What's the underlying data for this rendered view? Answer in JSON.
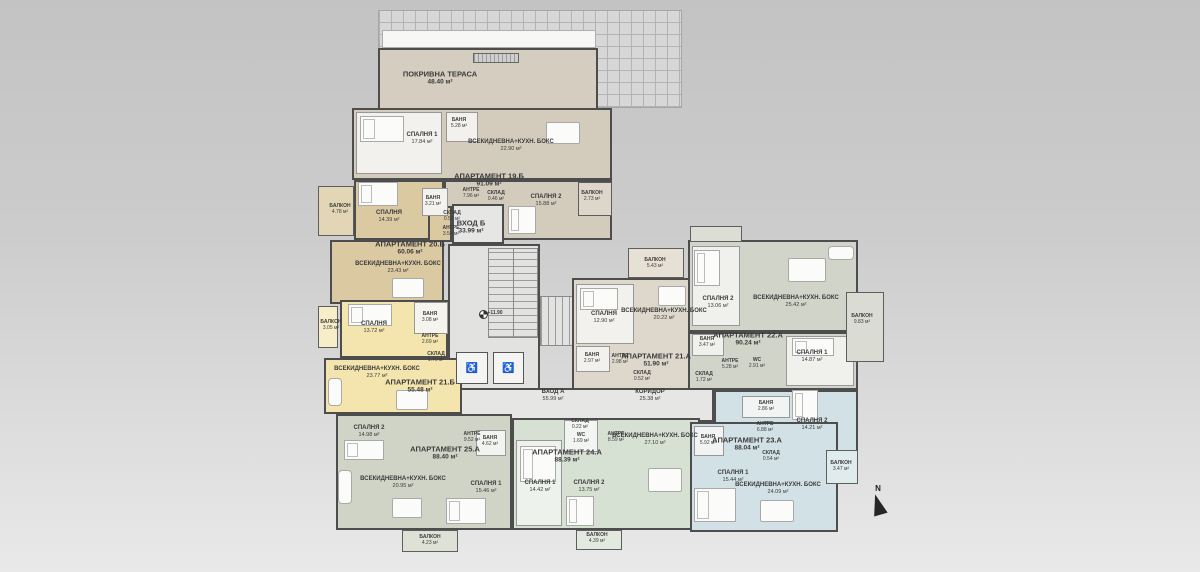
{
  "plan_title": "Floor plan level +11.90",
  "north": {
    "label": "N"
  },
  "level": {
    "label": "+11.90"
  },
  "colors": {
    "wall": "#4d4d4d",
    "apt19": "#d3cbbc",
    "apt20": "#dbc9a2",
    "apt21b": "#f4e5ae",
    "apt21a": "#ddd8cb",
    "apt22": "#d0d4c9",
    "apt23": "#d2e1e5",
    "apt24": "#d6e1d3",
    "apt25": "#cfd4c7",
    "terrace": "#d5cdbf",
    "common": "#e4e4e2"
  },
  "regions": [
    {
      "id": "roof-hatch",
      "cls": "roof",
      "x": 378,
      "y": 10,
      "w": 304,
      "h": 98,
      "fill": "#d7d7d7"
    },
    {
      "id": "terrace-strip",
      "cls": "strip",
      "x": 382,
      "y": 30,
      "w": 214,
      "h": 18,
      "fill": "#f7f7f5"
    },
    {
      "id": "roof-terrace",
      "cls": "apartment",
      "x": 378,
      "y": 48,
      "w": 220,
      "h": 64,
      "fill": "#d5cdbf"
    },
    {
      "id": "terrace-vent",
      "cls": "vent",
      "x": 473,
      "y": 53,
      "w": 46,
      "h": 10,
      "fill": "#cfcfcf"
    },
    {
      "id": "corridor",
      "cls": "core",
      "x": 452,
      "y": 388,
      "w": 262,
      "h": 34,
      "fill": "#e6e6e4"
    },
    {
      "id": "core-stairwell",
      "cls": "core",
      "x": 448,
      "y": 244,
      "w": 92,
      "h": 146,
      "fill": "#e2e2e0"
    },
    {
      "id": "apt19-main",
      "cls": "apartment",
      "x": 352,
      "y": 108,
      "w": 260,
      "h": 72,
      "fill": "#d3cbbc"
    },
    {
      "id": "apt19-south",
      "cls": "apartment",
      "x": 444,
      "y": 180,
      "w": 168,
      "h": 60,
      "fill": "#d3cbbc"
    },
    {
      "id": "entrance-b-hall",
      "cls": "core",
      "x": 452,
      "y": 204,
      "w": 52,
      "h": 40,
      "fill": "#e6e6e4"
    },
    {
      "id": "apt19-bedroom1-room",
      "cls": "room",
      "x": 356,
      "y": 112,
      "w": 86,
      "h": 62,
      "fill": "#f2f1ed"
    },
    {
      "id": "apt19-bath-room",
      "cls": "room",
      "x": 446,
      "y": 112,
      "w": 32,
      "h": 30,
      "fill": "#f2f1ed"
    },
    {
      "id": "apt19-balcony",
      "cls": "balcony",
      "x": 578,
      "y": 182,
      "w": 34,
      "h": 34,
      "fill": "#ddd6c9"
    },
    {
      "id": "apt20-bedroom-wing",
      "cls": "apartment",
      "x": 354,
      "y": 180,
      "w": 90,
      "h": 60,
      "fill": "#dbc9a2"
    },
    {
      "id": "apt20-living",
      "cls": "apartment",
      "x": 330,
      "y": 240,
      "w": 114,
      "h": 64,
      "fill": "#dbc9a2"
    },
    {
      "id": "apt20-hall",
      "cls": "apartment",
      "x": 428,
      "y": 206,
      "w": 24,
      "h": 36,
      "fill": "#dbc9a2"
    },
    {
      "id": "apt20-bath-room",
      "cls": "room",
      "x": 422,
      "y": 188,
      "w": 26,
      "h": 28,
      "fill": "#f4f2ee"
    },
    {
      "id": "apt20-balcony",
      "cls": "balcony",
      "x": 318,
      "y": 186,
      "w": 36,
      "h": 50,
      "fill": "#e3d6b6"
    },
    {
      "id": "apt21b-bedroom-wing",
      "cls": "apartment",
      "x": 340,
      "y": 300,
      "w": 108,
      "h": 58,
      "fill": "#f4e5ae"
    },
    {
      "id": "apt21b-living",
      "cls": "apartment",
      "x": 324,
      "y": 358,
      "w": 138,
      "h": 56,
      "fill": "#f4e5ae"
    },
    {
      "id": "apt21b-bath-room",
      "cls": "room",
      "x": 414,
      "y": 302,
      "w": 34,
      "h": 32,
      "fill": "#f6f4ee"
    },
    {
      "id": "apt21b-balcony",
      "cls": "balcony",
      "x": 318,
      "y": 306,
      "w": 20,
      "h": 42,
      "fill": "#f7edc8"
    },
    {
      "id": "stairs-upper",
      "cls": "stairs",
      "x": 488,
      "y": 248,
      "w": 50,
      "h": 90,
      "fill": "#e2e2e0"
    },
    {
      "id": "stairs-lower",
      "cls": "stairs-h",
      "x": 540,
      "y": 296,
      "w": 44,
      "h": 50,
      "fill": "#e2e2e0"
    },
    {
      "id": "elevator-1",
      "cls": "elevator",
      "x": 456,
      "y": 352,
      "w": 32,
      "h": 32,
      "fill": "#f4f4f2",
      "icon": "♿"
    },
    {
      "id": "elevator-2",
      "cls": "elevator",
      "x": 493,
      "y": 352,
      "w": 31,
      "h": 32,
      "fill": "#f4f4f2",
      "icon": "♿"
    },
    {
      "id": "apt21a-main",
      "cls": "apartment",
      "x": 572,
      "y": 278,
      "w": 128,
      "h": 112,
      "fill": "#ddd8cb"
    },
    {
      "id": "apt21a-bedroom-room",
      "cls": "room",
      "x": 576,
      "y": 284,
      "w": 58,
      "h": 60,
      "fill": "#f2f1ed"
    },
    {
      "id": "apt21a-bath-room",
      "cls": "room",
      "x": 576,
      "y": 346,
      "w": 34,
      "h": 26,
      "fill": "#f2f1ed"
    },
    {
      "id": "apt21a-balcony",
      "cls": "balcony",
      "x": 628,
      "y": 248,
      "w": 56,
      "h": 30,
      "fill": "#e6e1d4"
    },
    {
      "id": "apt22-north",
      "cls": "apartment",
      "x": 688,
      "y": 240,
      "w": 170,
      "h": 92,
      "fill": "#d0d4c9"
    },
    {
      "id": "apt22-south",
      "cls": "apartment",
      "x": 688,
      "y": 332,
      "w": 170,
      "h": 58,
      "fill": "#d0d4c9"
    },
    {
      "id": "apt22-bedroom2-room",
      "cls": "room",
      "x": 692,
      "y": 246,
      "w": 48,
      "h": 80,
      "fill": "#f0f1ec"
    },
    {
      "id": "apt22-bath-room",
      "cls": "room",
      "x": 692,
      "y": 334,
      "w": 32,
      "h": 22,
      "fill": "#f0f1ec"
    },
    {
      "id": "apt22-bedroom1-room",
      "cls": "room",
      "x": 786,
      "y": 336,
      "w": 68,
      "h": 50,
      "fill": "#f0f1ec"
    },
    {
      "id": "apt22-balcony",
      "cls": "balcony",
      "x": 846,
      "y": 292,
      "w": 38,
      "h": 70,
      "fill": "#dadcd4"
    },
    {
      "id": "apt22-top-balcony",
      "cls": "balcony",
      "x": 690,
      "y": 226,
      "w": 52,
      "h": 16,
      "fill": "#dcded6"
    },
    {
      "id": "apt24-main",
      "cls": "apartment",
      "x": 512,
      "y": 418,
      "w": 188,
      "h": 112,
      "fill": "#d6e1d3"
    },
    {
      "id": "apt24-wc-room",
      "cls": "room",
      "x": 564,
      "y": 420,
      "w": 34,
      "h": 32,
      "fill": "#f2f5f1"
    },
    {
      "id": "apt24-bedroom1-room",
      "cls": "room",
      "x": 516,
      "y": 440,
      "w": 46,
      "h": 86,
      "fill": "#eef2ec"
    },
    {
      "id": "apt24-balcony",
      "cls": "balcony",
      "x": 576,
      "y": 530,
      "w": 46,
      "h": 20,
      "fill": "#e2eadf"
    },
    {
      "id": "apt23-north",
      "cls": "apartment",
      "x": 714,
      "y": 390,
      "w": 144,
      "h": 70,
      "fill": "#d2e1e5"
    },
    {
      "id": "apt23-main",
      "cls": "apartment",
      "x": 690,
      "y": 422,
      "w": 148,
      "h": 110,
      "fill": "#d2e1e5"
    },
    {
      "id": "apt23-bath1-room",
      "cls": "room",
      "x": 694,
      "y": 426,
      "w": 30,
      "h": 30,
      "fill": "#f2f4f4"
    },
    {
      "id": "apt23-bath2-room",
      "cls": "room",
      "x": 742,
      "y": 396,
      "w": 48,
      "h": 22,
      "fill": "#f2f4f4"
    },
    {
      "id": "apt23-balcony",
      "cls": "balcony",
      "x": 826,
      "y": 450,
      "w": 32,
      "h": 34,
      "fill": "#e0ebee"
    },
    {
      "id": "apt25-main",
      "cls": "apartment",
      "x": 336,
      "y": 414,
      "w": 176,
      "h": 116,
      "fill": "#cfd4c7"
    },
    {
      "id": "apt25-bath-room",
      "cls": "room",
      "x": 476,
      "y": 430,
      "w": 30,
      "h": 26,
      "fill": "#f2f4f0"
    },
    {
      "id": "apt25-balcony",
      "cls": "balcony",
      "x": 402,
      "y": 530,
      "w": 56,
      "h": 22,
      "fill": "#dde1d6"
    }
  ],
  "labels": [
    {
      "id": "terrace-label",
      "n": "ПОКРИВНА ТЕРАСА",
      "a": "48.40 м²",
      "x": 440,
      "y": 78,
      "s": "t"
    },
    {
      "id": "apt19-bedroom1-label",
      "n": "СПАЛНЯ 1",
      "a": "17.84 м²",
      "x": 422,
      "y": 139,
      "s": "m"
    },
    {
      "id": "apt19-bath-label",
      "n": "БАНЯ",
      "a": "5.28 м²",
      "x": 459,
      "y": 123,
      "s": "s"
    },
    {
      "id": "apt19-living-label",
      "n": "ВСЕКИДНЕВНА+КУХН. БОКС",
      "a": "22.90 м²",
      "x": 511,
      "y": 146,
      "s": "m"
    },
    {
      "id": "apt19-title",
      "n": "АПАРТАМЕНТ 19.Б",
      "a": "91.09 м²",
      "x": 489,
      "y": 180,
      "s": "t"
    },
    {
      "id": "apt19-hall-label",
      "n": "АНТРЕ",
      "a": "7.96 м²",
      "x": 471,
      "y": 193,
      "s": "s"
    },
    {
      "id": "apt19-storage-label",
      "n": "СКЛАД",
      "a": "0.46 м²",
      "x": 496,
      "y": 196,
      "s": "s"
    },
    {
      "id": "apt19-bedroom2-label",
      "n": "СПАЛНЯ 2",
      "a": "15.88 м²",
      "x": 546,
      "y": 201,
      "s": "m"
    },
    {
      "id": "apt19-balcony-label",
      "n": "БАЛКОН",
      "a": "2.73 м²",
      "x": 592,
      "y": 196,
      "s": "s"
    },
    {
      "id": "apt20-balcony-label",
      "n": "БАЛКОН",
      "a": "4.78 м²",
      "x": 340,
      "y": 209,
      "s": "s"
    },
    {
      "id": "apt20-bedroom-label",
      "n": "СПАЛНЯ",
      "a": "14.39 м²",
      "x": 389,
      "y": 217,
      "s": "m"
    },
    {
      "id": "apt20-bath-label",
      "n": "БАНЯ",
      "a": "3.21 м²",
      "x": 433,
      "y": 201,
      "s": "s"
    },
    {
      "id": "apt20-storage-label",
      "n": "СКЛАД",
      "a": "0.50 м²",
      "x": 452,
      "y": 216,
      "s": "s"
    },
    {
      "id": "apt20-hall-label",
      "n": "АНТРЕ",
      "a": "3.54 м²",
      "x": 451,
      "y": 231,
      "s": "s"
    },
    {
      "id": "apt20-title",
      "n": "АПАРТАМЕНТ 20.Б",
      "a": "60.06 м²",
      "x": 410,
      "y": 248,
      "s": "t"
    },
    {
      "id": "apt20-living-label",
      "n": "ВСЕКИДНЕВНА+КУХН. БОКС",
      "a": "23.43 м²",
      "x": 398,
      "y": 268,
      "s": "m"
    },
    {
      "id": "entrance-b-label",
      "n": "ВХОД Б",
      "a": "33.99 м²",
      "x": 471,
      "y": 227,
      "s": "t"
    },
    {
      "id": "apt21b-balcony-label",
      "n": "БАЛКОН",
      "a": "3.05 м²",
      "x": 331,
      "y": 325,
      "s": "s"
    },
    {
      "id": "apt21b-bedroom-label",
      "n": "СПАЛНЯ",
      "a": "13.72 м²",
      "x": 374,
      "y": 328,
      "s": "m"
    },
    {
      "id": "apt21b-bath-label",
      "n": "БАНЯ",
      "a": "3.08 м²",
      "x": 430,
      "y": 317,
      "s": "s"
    },
    {
      "id": "apt21b-hall-label",
      "n": "АНТРЕ",
      "a": "2.69 м²",
      "x": 430,
      "y": 339,
      "s": "s"
    },
    {
      "id": "apt21b-storage-label",
      "n": "СКЛАД",
      "a": "1.70 м²",
      "x": 436,
      "y": 357,
      "s": "s"
    },
    {
      "id": "apt21b-living-label",
      "n": "ВСЕКИДНЕВНА+КУХН. БОКС",
      "a": "23.77 м²",
      "x": 377,
      "y": 373,
      "s": "m"
    },
    {
      "id": "apt21b-title",
      "n": "АПАРТАМЕНТ 21.Б",
      "a": "55.48 м²",
      "x": 420,
      "y": 386,
      "s": "t"
    },
    {
      "id": "level-label",
      "n": "+11.90",
      "x": 495,
      "y": 313,
      "s": "s"
    },
    {
      "id": "entrance-a-label",
      "n": "ВХОД А",
      "a": "55.99 м²",
      "x": 553,
      "y": 396,
      "s": "m"
    },
    {
      "id": "corridor-label",
      "n": "КОРИДОР",
      "a": "25.38 м²",
      "x": 650,
      "y": 396,
      "s": "m"
    },
    {
      "id": "apt21a-balcony-label",
      "n": "БАЛКОН",
      "a": "5.43 м²",
      "x": 655,
      "y": 263,
      "s": "s"
    },
    {
      "id": "apt21a-bedroom-label",
      "n": "СПАЛНЯ",
      "a": "12.90 м²",
      "x": 604,
      "y": 318,
      "s": "m"
    },
    {
      "id": "apt21a-living-label",
      "n": "ВСЕКИДНЕВНА+КУХН. БОКС",
      "a": "20.22 м²",
      "x": 664,
      "y": 315,
      "s": "m"
    },
    {
      "id": "apt21a-bath-label",
      "n": "БАНЯ",
      "a": "2.97 м²",
      "x": 592,
      "y": 358,
      "s": "s"
    },
    {
      "id": "apt21a-hall-label",
      "n": "АНТРЕ",
      "a": "2.98 м²",
      "x": 620,
      "y": 359,
      "s": "s"
    },
    {
      "id": "apt21a-title",
      "n": "АПАРТАМЕНТ 21.А",
      "a": "51.90 м²",
      "x": 656,
      "y": 360,
      "s": "t"
    },
    {
      "id": "apt21a-storage-label",
      "n": "СКЛАД",
      "a": "0.52 м²",
      "x": 642,
      "y": 376,
      "s": "s"
    },
    {
      "id": "apt22-bedroom2-label",
      "n": "СПАЛНЯ 2",
      "a": "13.06 м²",
      "x": 718,
      "y": 303,
      "s": "m"
    },
    {
      "id": "apt22-living-label",
      "n": "ВСЕКИДНЕВНА+КУХН. БОКС",
      "a": "25.42 м²",
      "x": 796,
      "y": 302,
      "s": "m"
    },
    {
      "id": "apt22-title",
      "n": "АПАРТАМЕНТ 22.А",
      "a": "90.24 м²",
      "x": 748,
      "y": 339,
      "s": "t"
    },
    {
      "id": "apt22-bath-label",
      "n": "БАНЯ",
      "a": "3.47 м²",
      "x": 707,
      "y": 342,
      "s": "s"
    },
    {
      "id": "apt22-hall-label",
      "n": "АНТРЕ",
      "a": "5.28 м²",
      "x": 730,
      "y": 364,
      "s": "s"
    },
    {
      "id": "apt22-wc-label",
      "n": "WC",
      "a": "2.91 м²",
      "x": 757,
      "y": 363,
      "s": "s"
    },
    {
      "id": "apt22-storage-label",
      "n": "СКЛАД",
      "a": "1.72 м²",
      "x": 704,
      "y": 377,
      "s": "s"
    },
    {
      "id": "apt22-bedroom1-label",
      "n": "СПАЛНЯ 1",
      "a": "14.87 м²",
      "x": 812,
      "y": 357,
      "s": "m"
    },
    {
      "id": "apt22-balcony-label",
      "n": "БАЛКОН",
      "a": "9.83 м²",
      "x": 862,
      "y": 319,
      "s": "s"
    },
    {
      "id": "apt23-bath2-label",
      "n": "БАНЯ",
      "a": "2.86 м²",
      "x": 766,
      "y": 406,
      "s": "s"
    },
    {
      "id": "apt23-hall-label",
      "n": "АНТРЕ",
      "a": "6.88 м²",
      "x": 765,
      "y": 427,
      "s": "s"
    },
    {
      "id": "apt23-bedroom2-label",
      "n": "СПАЛНЯ 2",
      "a": "14.21 м²",
      "x": 812,
      "y": 425,
      "s": "m"
    },
    {
      "id": "apt23-bath1-label",
      "n": "БАНЯ",
      "a": "5.92 м²",
      "x": 708,
      "y": 440,
      "s": "s"
    },
    {
      "id": "apt23-title",
      "n": "АПАРТАМЕНТ 23.А",
      "a": "88.04 м²",
      "x": 747,
      "y": 444,
      "s": "t"
    },
    {
      "id": "apt23-storage-label",
      "n": "СКЛАД",
      "a": "0.54 м²",
      "x": 771,
      "y": 456,
      "s": "s"
    },
    {
      "id": "apt23-bedroom1-label",
      "n": "СПАЛНЯ 1",
      "a": "15.44 м²",
      "x": 733,
      "y": 477,
      "s": "m"
    },
    {
      "id": "apt23-living-label",
      "n": "ВСЕКИДНЕВНА+КУХН. БОКС",
      "a": "24.09 м²",
      "x": 778,
      "y": 489,
      "s": "m"
    },
    {
      "id": "apt23-balcony-label",
      "n": "БАЛКОН",
      "a": "3.47 м²",
      "x": 841,
      "y": 466,
      "s": "s"
    },
    {
      "id": "apt24-storage-label",
      "n": "СКЛАД",
      "a": "0.22 м²",
      "x": 580,
      "y": 424,
      "s": "s"
    },
    {
      "id": "apt24-wc-label",
      "n": "WC",
      "a": "1.69 м²",
      "x": 581,
      "y": 438,
      "s": "s"
    },
    {
      "id": "apt24-hall-label",
      "n": "АНТРЕ",
      "a": "8.59 м²",
      "x": 616,
      "y": 437,
      "s": "s"
    },
    {
      "id": "apt24-living-label",
      "n": "ВСЕКИДНЕВНА+КУХН. БОКС",
      "a": "27.10 м²",
      "x": 655,
      "y": 440,
      "s": "m"
    },
    {
      "id": "apt24-title",
      "n": "АПАРТАМЕНТ 24.А",
      "a": "88.39 м²",
      "x": 567,
      "y": 456,
      "s": "t"
    },
    {
      "id": "apt24-bedroom1-label",
      "n": "СПАЛНЯ 1",
      "a": "14.42 м²",
      "x": 540,
      "y": 487,
      "s": "m"
    },
    {
      "id": "apt24-bedroom2-label",
      "n": "СПАЛНЯ 2",
      "a": "13.75 м²",
      "x": 589,
      "y": 487,
      "s": "m"
    },
    {
      "id": "apt24-balcony-label",
      "n": "БАЛКОН",
      "a": "4.39 м²",
      "x": 597,
      "y": 538,
      "s": "s"
    },
    {
      "id": "apt25-bedroom2-label",
      "n": "СПАЛНЯ 2",
      "a": "14.98 м²",
      "x": 369,
      "y": 432,
      "s": "m"
    },
    {
      "id": "apt25-hall-label",
      "n": "АНТРЕ",
      "a": "9.52 м²",
      "x": 472,
      "y": 437,
      "s": "s"
    },
    {
      "id": "apt25-bath-label",
      "n": "БАНЯ",
      "a": "4.62 м²",
      "x": 490,
      "y": 441,
      "s": "s"
    },
    {
      "id": "apt25-title",
      "n": "АПАРТАМЕНТ 25.А",
      "a": "88.40 м²",
      "x": 445,
      "y": 453,
      "s": "t"
    },
    {
      "id": "apt25-living-label",
      "n": "ВСЕКИДНЕВНА+КУХН. БОКС",
      "a": "20.95 м²",
      "x": 403,
      "y": 483,
      "s": "m"
    },
    {
      "id": "apt25-bedroom1-label",
      "n": "СПАЛНЯ 1",
      "a": "15.46 м²",
      "x": 486,
      "y": 488,
      "s": "m"
    },
    {
      "id": "apt25-balcony-label",
      "n": "БАЛКОН",
      "a": "4.23 м²",
      "x": 430,
      "y": 540,
      "s": "s"
    }
  ],
  "furniture": [
    {
      "k": "bed",
      "x": 360,
      "y": 116,
      "w": 44,
      "h": 26
    },
    {
      "k": "bed",
      "x": 508,
      "y": 206,
      "w": 28,
      "h": 28
    },
    {
      "k": "bed",
      "x": 358,
      "y": 182,
      "w": 40,
      "h": 24
    },
    {
      "k": "bed",
      "x": 348,
      "y": 304,
      "w": 44,
      "h": 22
    },
    {
      "k": "bed",
      "x": 580,
      "y": 288,
      "w": 38,
      "h": 22
    },
    {
      "k": "bed",
      "x": 694,
      "y": 250,
      "w": 26,
      "h": 36
    },
    {
      "k": "bed",
      "x": 792,
      "y": 338,
      "w": 42,
      "h": 18
    },
    {
      "k": "bed",
      "x": 792,
      "y": 390,
      "w": 26,
      "h": 30
    },
    {
      "k": "bed",
      "x": 694,
      "y": 488,
      "w": 42,
      "h": 34
    },
    {
      "k": "bed",
      "x": 520,
      "y": 446,
      "w": 36,
      "h": 36
    },
    {
      "k": "bed",
      "x": 566,
      "y": 496,
      "w": 28,
      "h": 30
    },
    {
      "k": "bed",
      "x": 344,
      "y": 440,
      "w": 40,
      "h": 20
    },
    {
      "k": "bed",
      "x": 446,
      "y": 498,
      "w": 40,
      "h": 26
    },
    {
      "k": "table",
      "x": 546,
      "y": 122,
      "w": 34,
      "h": 22
    },
    {
      "k": "table",
      "x": 392,
      "y": 278,
      "w": 32,
      "h": 20
    },
    {
      "k": "table",
      "x": 396,
      "y": 390,
      "w": 32,
      "h": 20
    },
    {
      "k": "table",
      "x": 658,
      "y": 286,
      "w": 28,
      "h": 20
    },
    {
      "k": "table",
      "x": 788,
      "y": 258,
      "w": 38,
      "h": 24
    },
    {
      "k": "table",
      "x": 760,
      "y": 500,
      "w": 34,
      "h": 22
    },
    {
      "k": "table",
      "x": 648,
      "y": 468,
      "w": 34,
      "h": 24
    },
    {
      "k": "table",
      "x": 392,
      "y": 498,
      "w": 30,
      "h": 20
    },
    {
      "k": "sofa",
      "x": 328,
      "y": 378,
      "w": 14,
      "h": 28
    },
    {
      "k": "sofa",
      "x": 828,
      "y": 246,
      "w": 26,
      "h": 14
    },
    {
      "k": "sofa",
      "x": 338,
      "y": 470,
      "w": 14,
      "h": 34
    }
  ]
}
